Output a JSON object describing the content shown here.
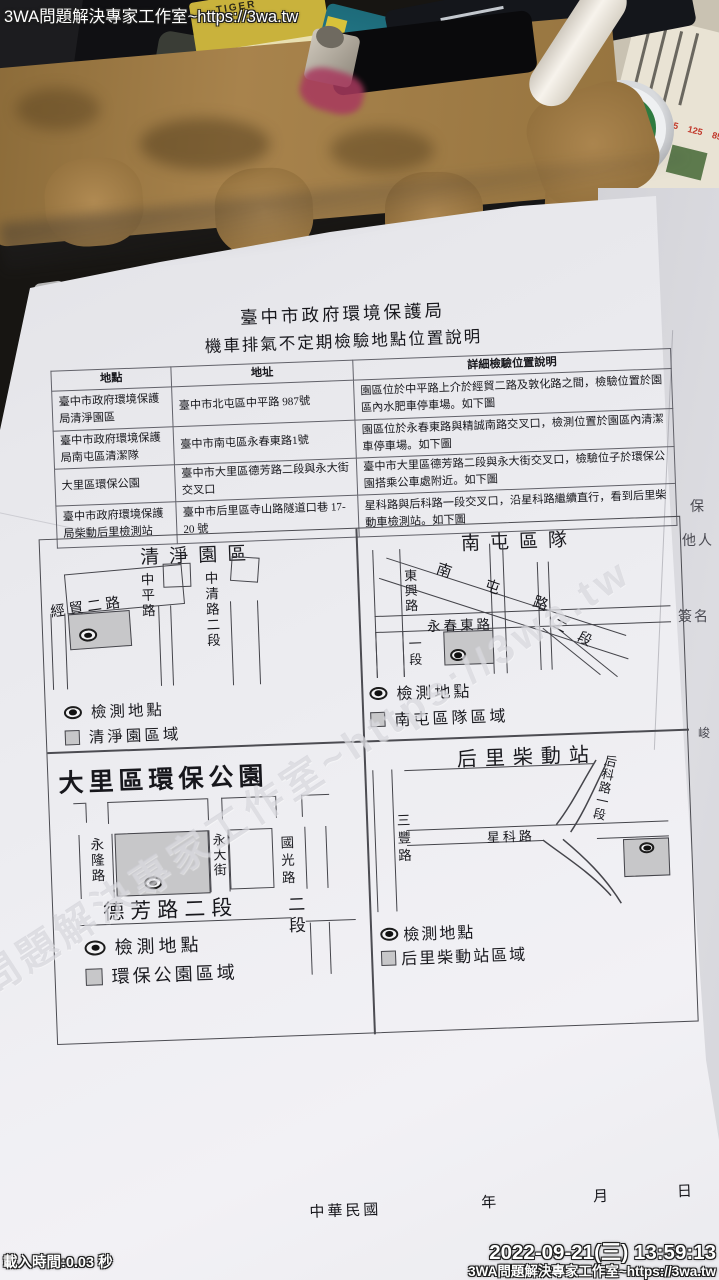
{
  "watermarks": {
    "site_top": "3WA問題解決專家工作室~https://3wa.tw",
    "site_diagonal": "3WA問題解決專家工作室~https://3wa.tw",
    "load_time": "載入時間:0.03 秒",
    "timestamp": "2022-09-21(三) 13:59:13",
    "site_bottom": "3WA問題解決專家工作室~https://3wa.tw"
  },
  "desk": {
    "keyboard": {
      "f11_key": "F11",
      "backspace_key": "Backspace"
    },
    "tin_brand": "MENTHOLATUM",
    "package_brand": "TIGER",
    "menu_prices": [
      "125",
      "125",
      "125",
      "125",
      "85"
    ]
  },
  "side_page_fragments": {
    "f1": "保",
    "f2": "他人",
    "f3": "簽名",
    "f4": "峻"
  },
  "document": {
    "title": "臺中市政府環境保護局",
    "subtitle": "機車排氣不定期檢驗地點位置說明",
    "table": {
      "headers": [
        "地點",
        "地址",
        "詳細檢驗位置說明"
      ],
      "rows": [
        [
          "臺中市政府環境保護局清淨園區",
          "臺中市北屯區中平路 987號",
          "園區位於中平路上介於經貿二路及敦化路之間，檢驗位置於園區內水肥車停車場。如下圖"
        ],
        [
          "臺中市政府環境保護局南屯區清潔隊",
          "臺中市南屯區永春東路1號",
          "園區位於永春東路與精誠南路交叉口，檢測位置於園區內清潔車停車場。如下圖"
        ],
        [
          "大里區環保公園",
          "臺中市大里區德芳路二段與永大街交叉口",
          "臺中市大里區德芳路二段與永大街交叉口，檢驗位子於環保公園搭乘公車處附近。如下圖"
        ],
        [
          "臺中市政府環境保護局柴動后里檢測站",
          "臺中市后里區寺山路隧道口巷 17-20 號",
          "星科路與后科路一段交叉口，沿星科路繼續直行，看到后里柴動車檢測站。如下圖"
        ]
      ]
    },
    "maps": {
      "qingjing": {
        "title": "清淨園區",
        "roads": {
          "jingmao": "經貿二路",
          "zhongping": "中平路",
          "zhongqing": "中清路二段"
        },
        "legend": {
          "dot": "檢測地點",
          "area": "清淨園區域"
        }
      },
      "nantun": {
        "title": "南屯區隊",
        "roads": {
          "dongxing": "東興路",
          "nantun_rd": "南屯路",
          "yongchun": "永春東路",
          "sec1": "一段",
          "sec2": "二段"
        },
        "legend": {
          "dot": "檢測地點",
          "area": "南屯區隊區域"
        }
      },
      "dali": {
        "title": "大里區環保公園",
        "roads": {
          "yonglong": "永隆路",
          "yongda": "永大街",
          "guoguang": "國光路",
          "defang": "德芳路二段",
          "sec2": "二段"
        },
        "legend": {
          "dot": "檢測地點",
          "area": "環保公園區域"
        }
      },
      "houli": {
        "title": "后里柴動站",
        "roads": {
          "sanfeng": "三豐路",
          "xingke": "星科路",
          "houke": "后科路一段"
        },
        "legend": {
          "dot": "檢測地點",
          "area": "后里柴動站區域"
        }
      }
    },
    "footer": {
      "era": "中華民國",
      "year": "年",
      "month": "月",
      "day": "日"
    }
  }
}
